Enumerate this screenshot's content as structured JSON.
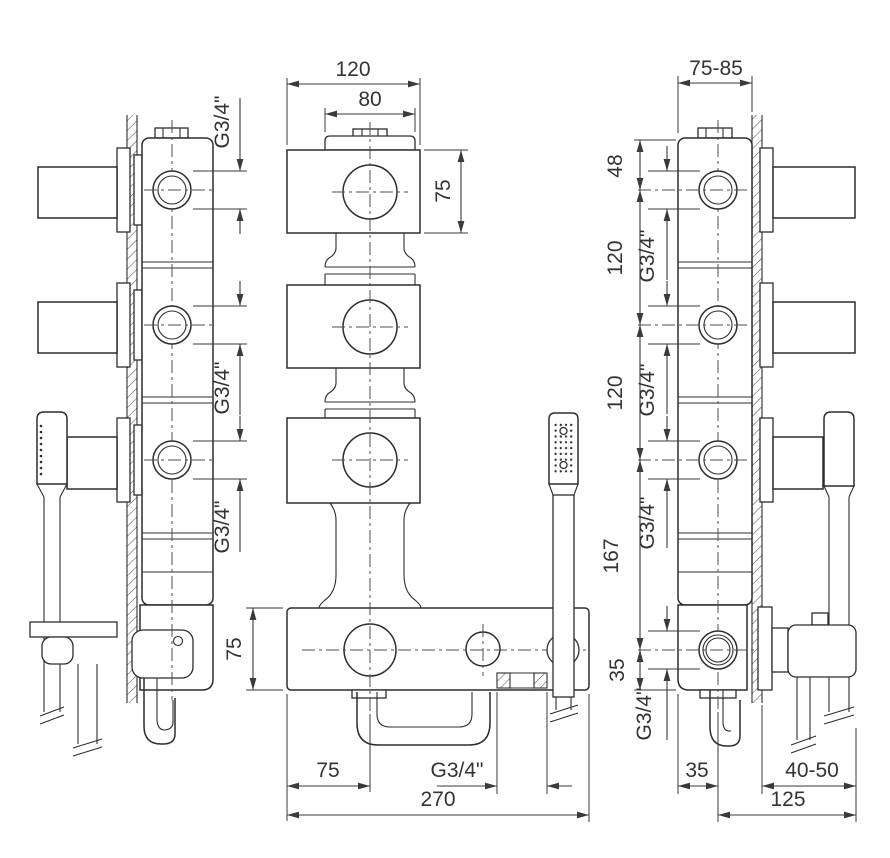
{
  "page": {
    "background": "#ffffff",
    "description": "Installation dimension drawing of a wall-mounted 3-handle thermostatic bath/shower mixer with handshower"
  },
  "drawing": {
    "type": "technical-dimension-drawing",
    "views": [
      {
        "id": "left-side-view",
        "description": "left profile with handshower and wall section"
      },
      {
        "id": "front-view",
        "description": "front view of valve column and bottom spout bar"
      },
      {
        "id": "right-side-view",
        "description": "right profile with dimension chain"
      }
    ],
    "dims": {
      "thread": "G3/4\"",
      "front_width": "120",
      "plate_width": "80",
      "block_height": "75",
      "bar_height": "75",
      "spout_offset": "75",
      "total_width": "270",
      "depth_range": "75-85",
      "top_to_port": "48",
      "port_spacing_a": "120",
      "port_spacing_b": "120",
      "port_to_outlet": "167",
      "outlet_to_bottom": "35",
      "edge_to_center": "35",
      "wall_range": "40-50",
      "center_to_hose": "125"
    },
    "line_color": "#2d2d2d",
    "dim_color": "#3a3a3a"
  }
}
